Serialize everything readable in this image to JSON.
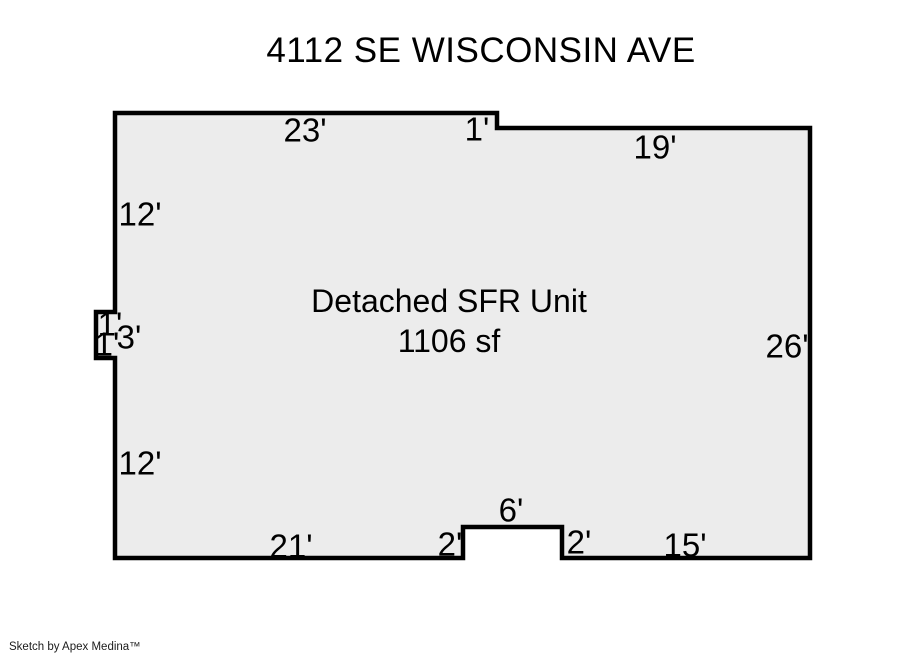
{
  "title": "4112 SE WISCONSIN AVE",
  "unit": {
    "name": "Detached SFR Unit",
    "area": "1106 sf"
  },
  "outline": {
    "points": "115,113 497,113 497,128 810,128 810,558 562,558 562,527 463,527 463,558 115,558 115,358 96,358 96,312 115,312"
  },
  "dimensions": {
    "top_left_wall": "23'",
    "top_step": "1'",
    "top_right_wall": "19'",
    "left_upper_wall": "12'",
    "left_notch_top": "1'",
    "left_notch_side": "3'",
    "left_notch_bottom": "1'",
    "left_lower_wall": "12'",
    "right_wall": "26'",
    "bottom_left_wall": "21'",
    "bottom_step_left": "2'",
    "bottom_inset_top": "6'",
    "bottom_step_right": "2'",
    "bottom_right_wall": "15'"
  },
  "footer": "Sketch by Apex Medina™",
  "colors": {
    "background": "#ffffff",
    "floor_fill": "#ececec",
    "outline": "#000000",
    "text": "#000000"
  }
}
